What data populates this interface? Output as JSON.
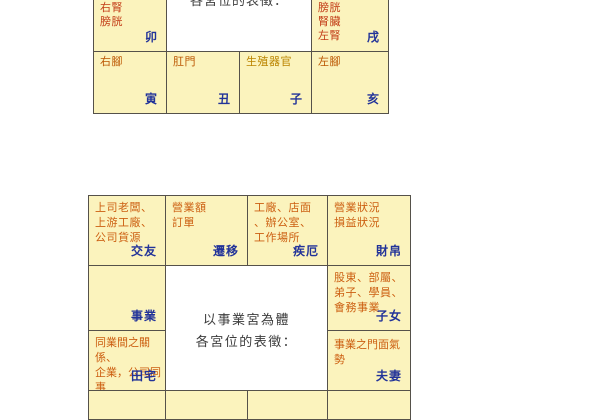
{
  "colors": {
    "cell_background": "#fbf3bd",
    "border": "#55514a",
    "body_part_text_red": "#c23b16",
    "body_part_text_orange": "#bb5500",
    "body_part_text_gold": "#bb8400",
    "career_text_orange": "#cc5f11",
    "branch_label_blue": "#223399",
    "caption_gray": "#3c3c3c",
    "page_background": "#ffffff"
  },
  "tables": {
    "body_map": {
      "center_caption_clipped": "各宮位的表徵：",
      "palaces": [
        {
          "id": "mao",
          "branch": "卯",
          "lines": [
            "右腎",
            "膀胱"
          ]
        },
        {
          "id": "xu",
          "branch": "戌",
          "lines": [
            "膀胱",
            "腎臟",
            "左腎"
          ]
        },
        {
          "id": "yin",
          "branch": "寅",
          "lines": [
            "右腳"
          ]
        },
        {
          "id": "chou",
          "branch": "丑",
          "lines": [
            "肛門"
          ]
        },
        {
          "id": "zi",
          "branch": "子",
          "lines": [
            "生殖器官"
          ]
        },
        {
          "id": "hai",
          "branch": "亥",
          "lines": [
            "左腳"
          ]
        }
      ]
    },
    "career_map": {
      "center_lines": [
        "以事業宮為體",
        "各宮位的表徵："
      ],
      "palaces": [
        {
          "id": "jiaoyou",
          "label": "交友",
          "lines": [
            "上司老闆、",
            "上游工廠、",
            "公司貨源"
          ]
        },
        {
          "id": "qianyi",
          "label": "遷移",
          "lines": [
            "營業額",
            "訂單"
          ]
        },
        {
          "id": "jie",
          "label": "疾厄",
          "lines": [
            "工廠、店面",
            "、辦公室、",
            "工作場所"
          ]
        },
        {
          "id": "caibo",
          "label": "財帛",
          "lines": [
            "營業狀況",
            "損益狀況"
          ]
        },
        {
          "id": "shiye",
          "label": "事業",
          "lines": []
        },
        {
          "id": "zinv",
          "label": "子女",
          "lines": [
            "股東、部屬、",
            "弟子、學員、",
            "會務事業"
          ]
        },
        {
          "id": "tianzhai",
          "label": "田宅",
          "lines": [
            "同業間之關係、",
            "企業，公司同事"
          ]
        },
        {
          "id": "fuqi",
          "label": "夫妻",
          "lines": [
            "事業之門面氣勢"
          ]
        }
      ]
    }
  }
}
